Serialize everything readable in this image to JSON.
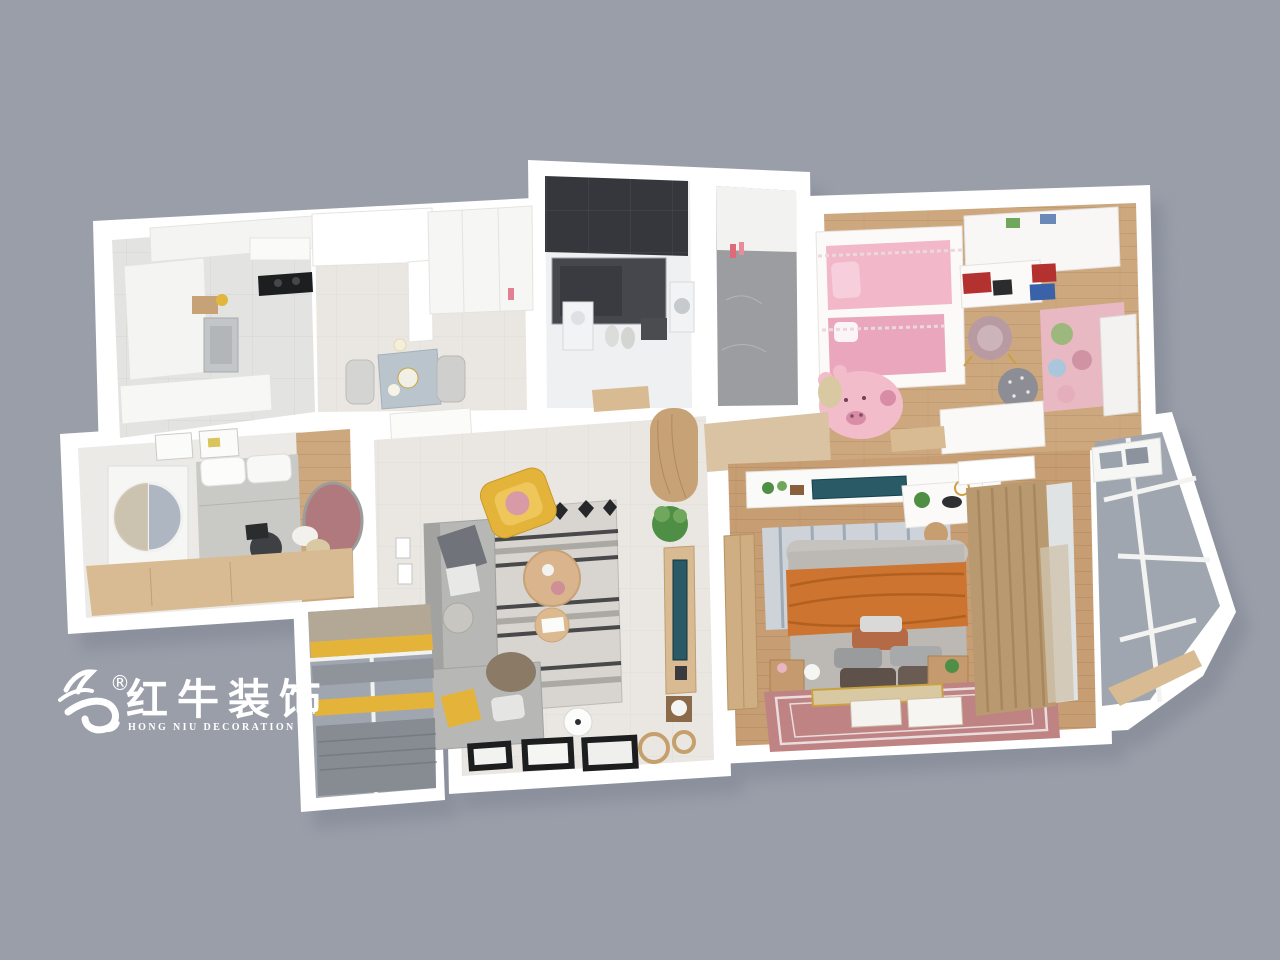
{
  "meta": {
    "description": "3D rendered top-down floor plan of a three-bedroom apartment on a gray background",
    "render_type": "3d-floorplan-dollhouse-view"
  },
  "logo": {
    "registered": "®",
    "chinese": "红牛装饰",
    "english": "HONG NIU DECORATION",
    "color": "#ffffff"
  },
  "rooms": [
    {
      "id": "kitchen",
      "label": "kitchen-dining"
    },
    {
      "id": "bathroom",
      "label": "bathroom-with-shower"
    },
    {
      "id": "utility",
      "label": "utility-room"
    },
    {
      "id": "kids-bedroom",
      "label": "kids-bedroom-pink"
    },
    {
      "id": "second-bedroom",
      "label": "second-bedroom-study"
    },
    {
      "id": "living-room",
      "label": "living-room"
    },
    {
      "id": "master-bedroom",
      "label": "master-bedroom"
    },
    {
      "id": "entry-hall",
      "label": "entry-hallway"
    },
    {
      "id": "balcony-left",
      "label": "balcony-yellow-blinds"
    },
    {
      "id": "balcony-right",
      "label": "glazed-balcony"
    }
  ],
  "colors": {
    "bg": "#999ea9",
    "shadow": "#747a88",
    "wall": "#ffffff",
    "wallSoft": "#f4f4f2",
    "wallEdge": "#e3e3e0",
    "tile": "#e3e3e1",
    "tileWarm": "#eae7e2",
    "grout": "#d0d0cd",
    "wood": "#cda87e",
    "woodMaster": "#c79e74",
    "woodDeep": "#b98f63",
    "woodCab": "#d8bb92",
    "woodCab2": "#c8a277",
    "pinkBed": "#f3b7ca",
    "pinkDeep": "#eaa6bd",
    "pinkSoft": "#f7cfdc",
    "pigRug": "#f2bcca",
    "pigSpot": "#d98ca6",
    "kidsBench": "#e9b9c3",
    "rose": "#bf8384",
    "mauve": "#b0797d",
    "mauveChair": "#b79aa2",
    "orange": "#cc7430",
    "orangeDeep": "#b25f20",
    "yellow": "#e4b33a",
    "teal": "#2a5a66",
    "sofa": "#b7b8b6",
    "sofaDark": "#a2a3a1",
    "cushDark": "#70747a",
    "rugBase": "#d8d5d0",
    "rugDark": "#26272b",
    "rugMid": "#8e8c88",
    "glass": "#9fa6b0",
    "glassDark": "#8c939e",
    "curtain": "#b9996f",
    "curtainDark": "#a3845c",
    "sheer": "#cfc3ae",
    "green": "#4f8f45",
    "greenLight": "#6fa85d",
    "marble": "#9b9da1",
    "bathDark": "#35373c",
    "shower": "#45474c",
    "steel": "#c2c6c9",
    "gold": "#c9a23f",
    "red": "#b3312e",
    "blue": "#3a62a8",
    "headRug": "#cdd3d9",
    "headRugLine": "#94a0ae",
    "benchTan": "#d9c9a2",
    "grayPillow": "#8d8d95",
    "bedGray": "#c9c9c6",
    "bedBody": "#bcb9b5"
  }
}
